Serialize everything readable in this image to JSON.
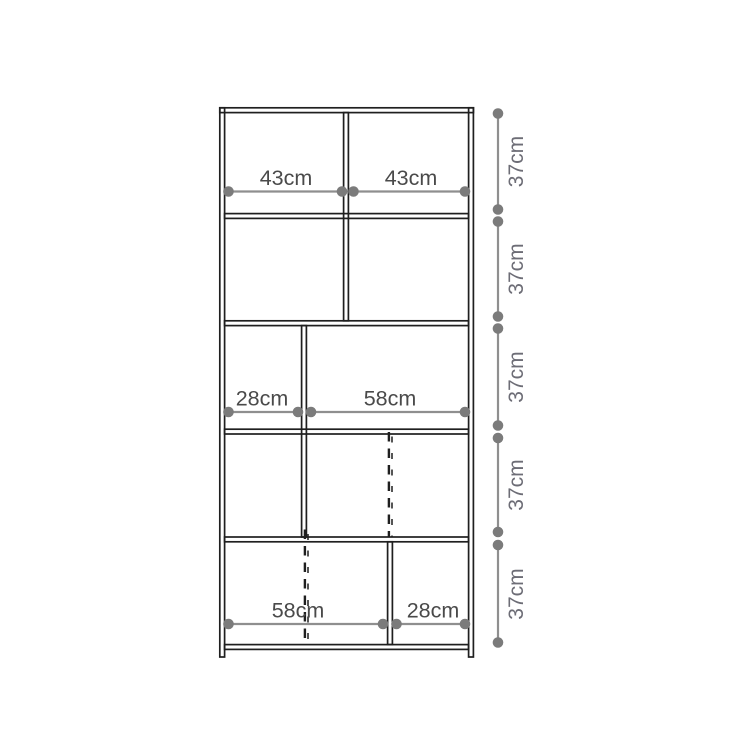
{
  "diagram": {
    "type": "furniture-dimension-drawing",
    "subject": "tall shelving unit, front elevation, 5 rows",
    "unit": "cm",
    "colors": {
      "background": "#ffffff",
      "structure_line": "#1f1f1f",
      "dimension_line": "#8f8f8f",
      "dimension_dot": "#7b7b7b",
      "width_label_text": "#4a4a4a",
      "height_label_text": "#6d6d76"
    },
    "width_dims": [
      {
        "label": "43cm"
      },
      {
        "label": "43cm"
      },
      {
        "label": "28cm"
      },
      {
        "label": "58cm"
      },
      {
        "label": "58cm"
      },
      {
        "label": "28cm"
      }
    ],
    "height_dims": [
      {
        "label": "37cm"
      },
      {
        "label": "37cm"
      },
      {
        "label": "37cm"
      },
      {
        "label": "37cm"
      },
      {
        "label": "37cm"
      }
    ]
  }
}
